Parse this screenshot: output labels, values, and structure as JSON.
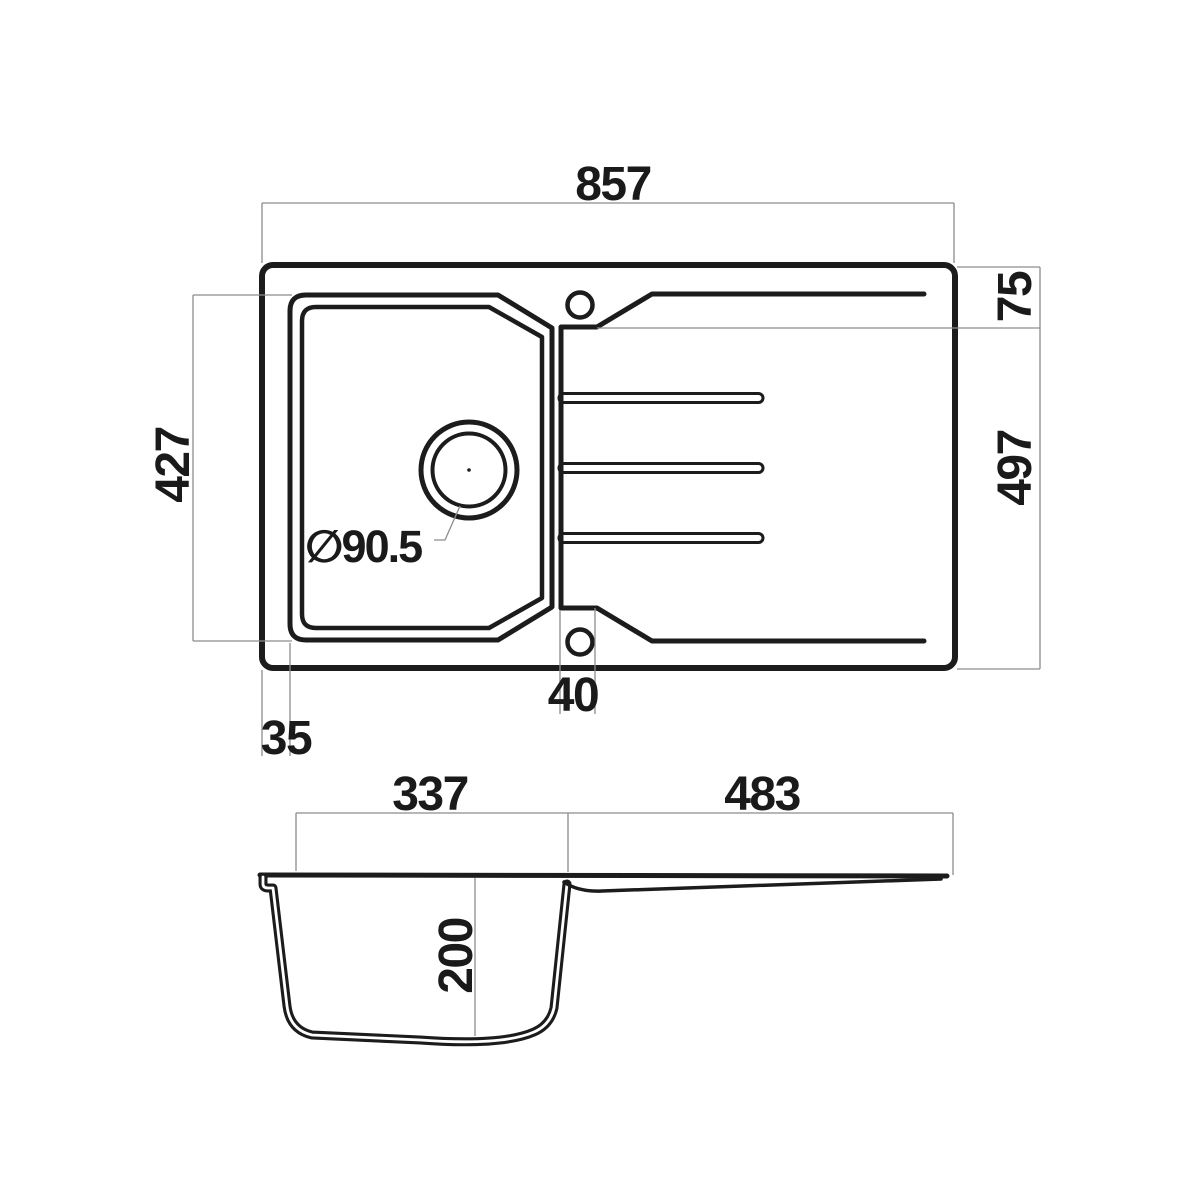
{
  "drawing": {
    "type": "technical-dimension-drawing",
    "subject": "kitchen sink with single bowl and drainboard",
    "background_color": "#ffffff",
    "outline_color": "#1c1c1c",
    "dimension_line_color": "#8c8c8c",
    "plan_view": {
      "dimensions": {
        "overall_width": "857",
        "rim_to_drainer_edge": "75",
        "overall_depth": "497",
        "bowl_length": "427",
        "edge_offset": "35",
        "hole_offset": "40",
        "drain_diameter": "∅90.5"
      },
      "features": {
        "faucet_holes": 2,
        "drainer_grooves": 3
      }
    },
    "section_view": {
      "dimensions": {
        "bowl_inner_width": "337",
        "drainer_length": "483",
        "bowl_depth": "200"
      }
    }
  }
}
